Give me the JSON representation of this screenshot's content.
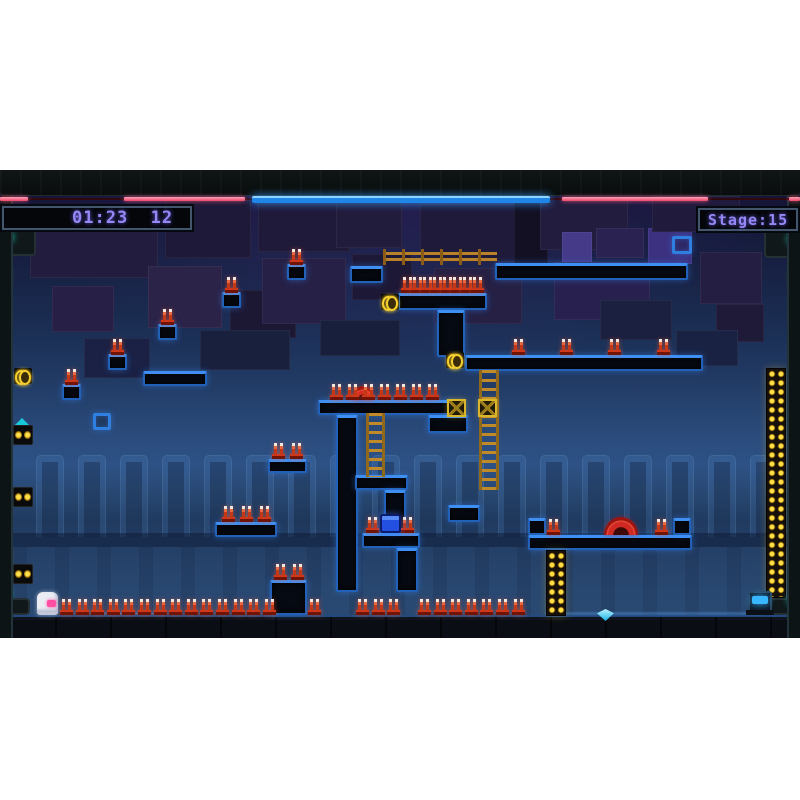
{
  "hud": {
    "timer": "01:23  12",
    "stage": "Stage:15",
    "strips": [
      {
        "x": 0,
        "y": 27,
        "w": 28,
        "h": 4
      },
      {
        "x": 124,
        "y": 27,
        "w": 121,
        "h": 4
      },
      {
        "x": 562,
        "y": 27,
        "w": 146,
        "h": 4
      },
      {
        "x": 789,
        "y": 27,
        "w": 11,
        "h": 4
      }
    ],
    "blue_bar": {
      "x": 252,
      "y": 26,
      "w": 298,
      "h": 7
    }
  },
  "theme": {
    "accent": "#3f8ff2",
    "spike": "#d0381c",
    "ladder": "#c08a28",
    "hud_text": "#9588f4",
    "pink": "#ff4fa2",
    "strip_pink": "#ef5f7e",
    "blue_bar": "#2f9df0",
    "yellow": "#ffd82a",
    "gem_cyan": "#18b0e0"
  },
  "level": {
    "origin_y": 170,
    "bg_panels": [
      {
        "x": 30,
        "y": 206,
        "w": 128,
        "h": 72,
        "c": "#221d3e"
      },
      {
        "x": 52,
        "y": 286,
        "w": 62,
        "h": 46,
        "c": "#271f46"
      },
      {
        "x": 165,
        "y": 200,
        "w": 86,
        "h": 58,
        "c": "#1e1938"
      },
      {
        "x": 148,
        "y": 266,
        "w": 74,
        "h": 62,
        "c": "#2b2348"
      },
      {
        "x": 230,
        "y": 290,
        "w": 66,
        "h": 48,
        "c": "#1c1834"
      },
      {
        "x": 258,
        "y": 198,
        "w": 92,
        "h": 54,
        "c": "#201a3a"
      },
      {
        "x": 262,
        "y": 258,
        "w": 84,
        "h": 66,
        "c": "#262046"
      },
      {
        "x": 336,
        "y": 202,
        "w": 66,
        "h": 46,
        "c": "#221c3c"
      },
      {
        "x": 352,
        "y": 254,
        "w": 60,
        "h": 46,
        "c": "#1d1836"
      },
      {
        "x": 420,
        "y": 204,
        "w": 96,
        "h": 58,
        "c": "#1f1a3a"
      },
      {
        "x": 434,
        "y": 268,
        "w": 88,
        "h": 56,
        "c": "#252044"
      },
      {
        "x": 514,
        "y": 196,
        "w": 34,
        "h": 70,
        "c": "#131024"
      },
      {
        "x": 540,
        "y": 198,
        "w": 88,
        "h": 52,
        "c": "#221c3e"
      },
      {
        "x": 562,
        "y": 232,
        "w": 30,
        "h": 46,
        "c": "#453a88"
      },
      {
        "x": 596,
        "y": 228,
        "w": 48,
        "h": 30,
        "c": "#2a2250"
      },
      {
        "x": 554,
        "y": 262,
        "w": 96,
        "h": 58,
        "c": "#282150"
      },
      {
        "x": 648,
        "y": 228,
        "w": 44,
        "h": 36,
        "c": "#3c3180"
      },
      {
        "x": 652,
        "y": 196,
        "w": 88,
        "h": 36,
        "c": "#201a3c"
      },
      {
        "x": 700,
        "y": 252,
        "w": 62,
        "h": 52,
        "c": "#241e42"
      },
      {
        "x": 716,
        "y": 304,
        "w": 48,
        "h": 38,
        "c": "#1e1a38"
      },
      {
        "x": 84,
        "y": 338,
        "w": 66,
        "h": 40,
        "c": "#1a2144"
      },
      {
        "x": 200,
        "y": 330,
        "w": 90,
        "h": 40,
        "c": "#18203e"
      },
      {
        "x": 320,
        "y": 320,
        "w": 80,
        "h": 36,
        "c": "#171f3c"
      },
      {
        "x": 600,
        "y": 300,
        "w": 72,
        "h": 40,
        "c": "#1b2040"
      },
      {
        "x": 676,
        "y": 330,
        "w": 62,
        "h": 36,
        "c": "#192242"
      }
    ],
    "pillars": {
      "start": 36,
      "step": 42,
      "count": 18,
      "y": 455,
      "w": 28,
      "h": 82
    },
    "bands": [
      {
        "x": 13,
        "y": 533,
        "w": 774,
        "h": 14
      }
    ],
    "vstripes": [
      {
        "x": 13,
        "y": 547,
        "w": 774,
        "h": 68
      }
    ],
    "platforms": [
      {
        "x": 495,
        "y": 263,
        "w": 193,
        "h": 17
      },
      {
        "x": 350,
        "y": 266,
        "w": 33,
        "h": 17
      },
      {
        "x": 398,
        "y": 293,
        "w": 89,
        "h": 17
      },
      {
        "x": 437,
        "y": 310,
        "w": 28,
        "h": 47
      },
      {
        "x": 465,
        "y": 355,
        "w": 238,
        "h": 16
      },
      {
        "x": 428,
        "y": 415,
        "w": 40,
        "h": 18
      },
      {
        "x": 143,
        "y": 371,
        "w": 64,
        "h": 15
      },
      {
        "x": 318,
        "y": 400,
        "w": 134,
        "h": 15
      },
      {
        "x": 336,
        "y": 415,
        "w": 22,
        "h": 177
      },
      {
        "x": 355,
        "y": 475,
        "w": 53,
        "h": 15
      },
      {
        "x": 384,
        "y": 490,
        "w": 22,
        "h": 45
      },
      {
        "x": 362,
        "y": 533,
        "w": 58,
        "h": 15
      },
      {
        "x": 396,
        "y": 548,
        "w": 22,
        "h": 44
      },
      {
        "x": 448,
        "y": 505,
        "w": 32,
        "h": 17
      },
      {
        "x": 215,
        "y": 522,
        "w": 62,
        "h": 15
      },
      {
        "x": 268,
        "y": 459,
        "w": 39,
        "h": 14
      },
      {
        "x": 270,
        "y": 580,
        "w": 37,
        "h": 35
      },
      {
        "x": 528,
        "y": 535,
        "w": 164,
        "h": 15
      },
      {
        "x": 528,
        "y": 518,
        "w": 18,
        "h": 17
      },
      {
        "x": 673,
        "y": 518,
        "w": 18,
        "h": 17
      },
      {
        "x": 222,
        "y": 292,
        "w": 19,
        "h": 16
      },
      {
        "x": 287,
        "y": 264,
        "w": 19,
        "h": 16
      },
      {
        "x": 158,
        "y": 324,
        "w": 19,
        "h": 16
      },
      {
        "x": 108,
        "y": 354,
        "w": 19,
        "h": 16
      },
      {
        "x": 62,
        "y": 384,
        "w": 19,
        "h": 16
      }
    ],
    "hollow_boxes": [
      {
        "x": 93,
        "y": 413,
        "w": 18,
        "h": 17
      },
      {
        "x": 672,
        "y": 236,
        "w": 20,
        "h": 18
      }
    ],
    "spike_rows": [
      {
        "x": 60,
        "y": 599,
        "n": 14,
        "step": 15.6
      },
      {
        "x": 308,
        "y": 599,
        "n": 1,
        "step": 15.6
      },
      {
        "x": 356,
        "y": 599,
        "n": 3,
        "step": 15.6
      },
      {
        "x": 418,
        "y": 599,
        "n": 7,
        "step": 15.6
      },
      {
        "x": 401,
        "y": 277,
        "n": 8,
        "step": 10
      },
      {
        "x": 512,
        "y": 339,
        "n": 1,
        "step": 16
      },
      {
        "x": 560,
        "y": 339,
        "n": 1,
        "step": 16
      },
      {
        "x": 608,
        "y": 339,
        "n": 1,
        "step": 16
      },
      {
        "x": 657,
        "y": 339,
        "n": 1,
        "step": 16
      },
      {
        "x": 330,
        "y": 384,
        "n": 7,
        "step": 16
      },
      {
        "x": 222,
        "y": 506,
        "n": 3,
        "step": 18
      },
      {
        "x": 272,
        "y": 443,
        "n": 2,
        "step": 18
      },
      {
        "x": 274,
        "y": 564,
        "n": 2,
        "step": 17
      },
      {
        "x": 547,
        "y": 519,
        "n": 1,
        "step": 16
      },
      {
        "x": 655,
        "y": 519,
        "n": 1,
        "step": 16
      },
      {
        "x": 366,
        "y": 517,
        "n": 1,
        "step": 16
      },
      {
        "x": 401,
        "y": 517,
        "n": 1,
        "step": 16
      },
      {
        "x": 225,
        "y": 277,
        "n": 1,
        "step": 16
      },
      {
        "x": 290,
        "y": 249,
        "n": 1,
        "step": 16
      },
      {
        "x": 161,
        "y": 309,
        "n": 1,
        "step": 16
      },
      {
        "x": 111,
        "y": 339,
        "n": 1,
        "step": 16
      },
      {
        "x": 65,
        "y": 369,
        "n": 1,
        "step": 16
      }
    ],
    "ladders": [
      {
        "x": 479,
        "y": 370,
        "w": 20,
        "h": 120
      },
      {
        "x": 366,
        "y": 413,
        "w": 19,
        "h": 64
      }
    ],
    "fence": {
      "x": 383,
      "y": 249,
      "w": 114,
      "h": 16
    },
    "crates": [
      {
        "x": 447,
        "y": 399,
        "w": 19,
        "h": 18
      },
      {
        "x": 478,
        "y": 399,
        "w": 19,
        "h": 18
      }
    ],
    "batteries": [
      {
        "x": 381,
        "y": 294,
        "w": 18,
        "h": 16
      },
      {
        "x": 446,
        "y": 352,
        "w": 18,
        "h": 16
      },
      {
        "x": 14,
        "y": 368,
        "w": 18,
        "h": 16
      }
    ],
    "light_columns": [
      {
        "x": 546,
        "y": 550,
        "w": 20,
        "h": 66
      },
      {
        "x": 766,
        "y": 368,
        "w": 20,
        "h": 230
      }
    ],
    "wheels": [
      {
        "x": 604,
        "y": 517,
        "w": 34,
        "h": 18
      },
      {
        "x": 352,
        "y": 386,
        "w": 22,
        "h": 14
      }
    ],
    "blue_box": {
      "x": 380,
      "y": 514,
      "w": 21,
      "h": 19
    },
    "gem": {
      "x": 597,
      "y": 609,
      "w": 17,
      "h": 12
    },
    "machine": {
      "x": 748,
      "y": 591,
      "w": 24,
      "h": 22
    },
    "player": {
      "x": 37,
      "y": 592,
      "w": 21,
      "h": 23
    },
    "sheens": [
      {
        "x": 545,
        "y": 612,
        "w": 218,
        "h": 3
      },
      {
        "x": 95,
        "y": 612,
        "w": 70,
        "h": 3
      }
    ],
    "plates": [
      {
        "x": 0,
        "y": 226,
        "w": 36,
        "h": 30
      },
      {
        "x": 764,
        "y": 228,
        "w": 36,
        "h": 30
      },
      {
        "x": 0,
        "y": 598,
        "w": 30,
        "h": 17
      },
      {
        "x": 770,
        "y": 598,
        "w": 30,
        "h": 17
      }
    ],
    "leds": [
      {
        "x": 5,
        "y": 232,
        "w": 8,
        "h": 10
      },
      {
        "x": 788,
        "y": 234,
        "w": 8,
        "h": 10
      },
      {
        "x": 788,
        "y": 596,
        "w": 7,
        "h": 8
      },
      {
        "x": 4,
        "y": 590,
        "w": 6,
        "h": 7
      }
    ],
    "capsules": [
      {
        "x": 2,
        "y": 267,
        "w": 6,
        "h": 20
      },
      {
        "x": 2,
        "y": 546,
        "w": 6,
        "h": 20
      },
      {
        "x": 792,
        "y": 267,
        "w": 6,
        "h": 20
      },
      {
        "x": 792,
        "y": 552,
        "w": 6,
        "h": 16
      }
    ],
    "speakers": [
      {
        "x": 13,
        "y": 425,
        "w": 20,
        "h": 20
      },
      {
        "x": 13,
        "y": 487,
        "w": 20,
        "h": 20
      },
      {
        "x": 13,
        "y": 564,
        "w": 20,
        "h": 20
      }
    ],
    "wedges": [
      {
        "x": 15,
        "y": 418,
        "w": 14,
        "h": 7
      }
    ]
  }
}
